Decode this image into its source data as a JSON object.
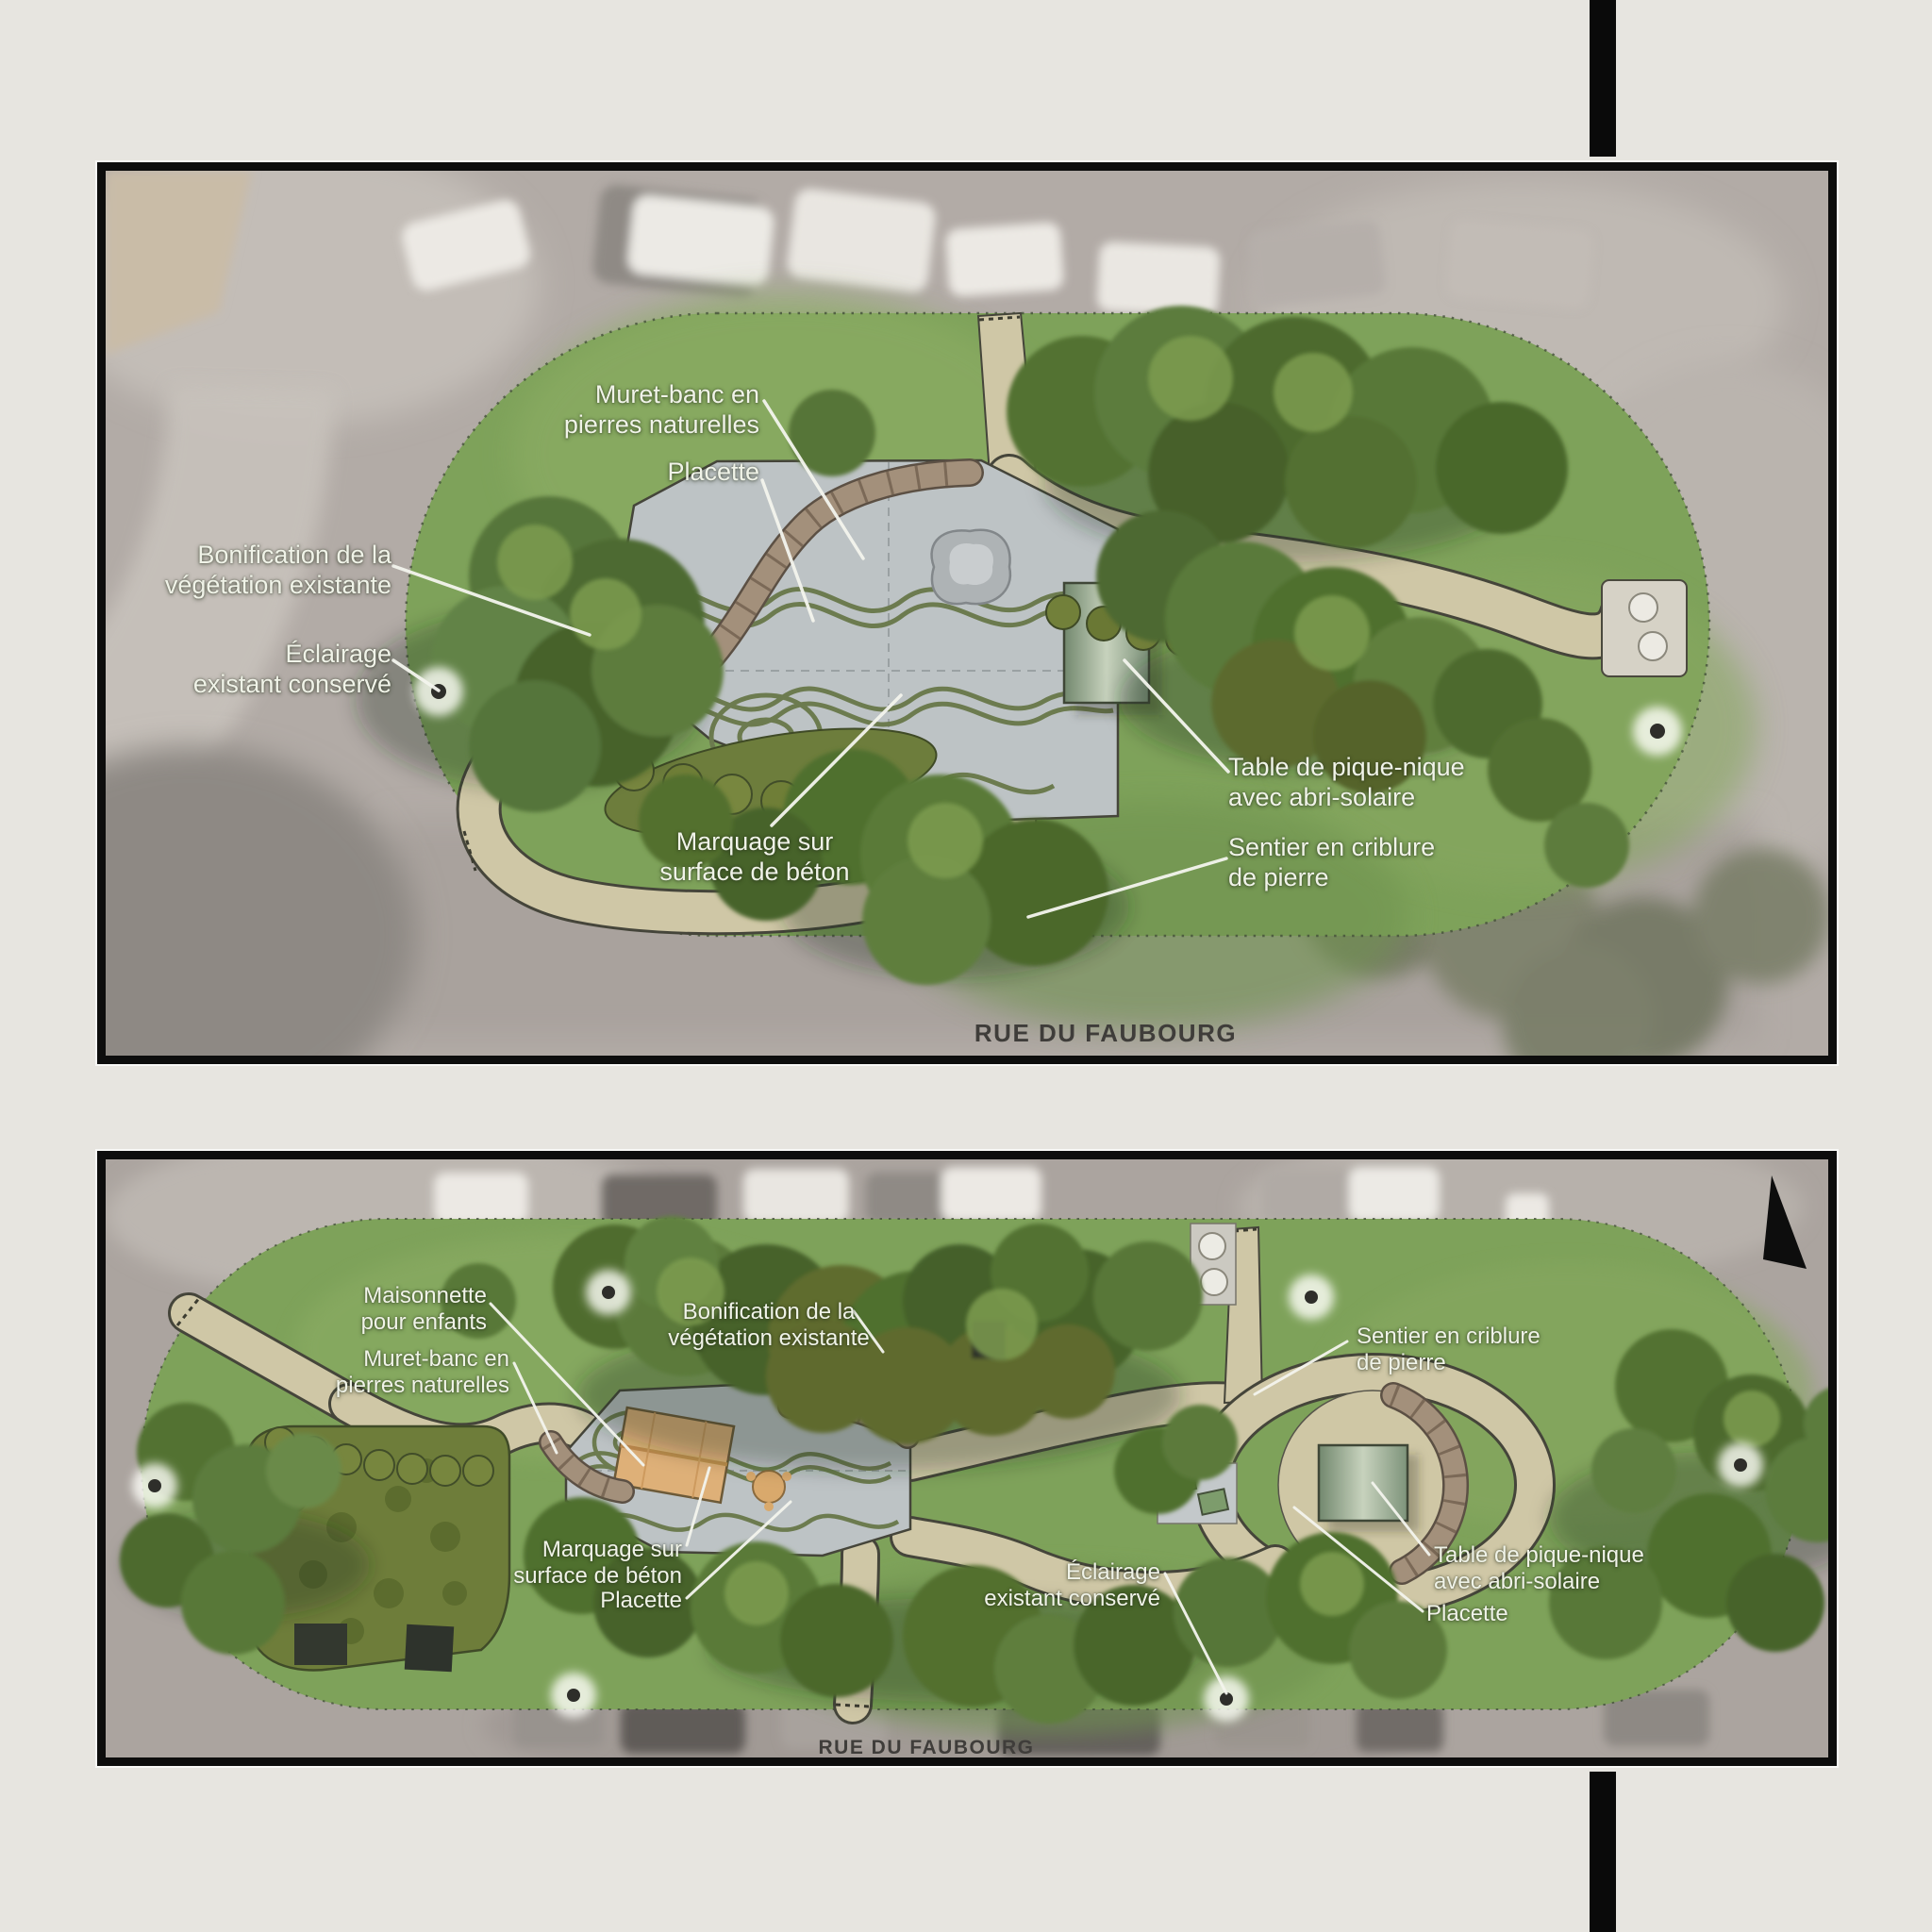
{
  "page": {
    "background": "#e7e5e0",
    "divider_color": "#0a0a0a",
    "frame_border_color": "#0d0d0d"
  },
  "colors": {
    "annotation_text": "#f0f3e8",
    "street_text": "#3f3d3a",
    "grass": "#7ea25a",
    "path": "#cfc7a6",
    "plaza_concrete": "#bdc3c5",
    "plaza_marking": "#6c7b4f",
    "stone_wall": "#9d8973",
    "shelter": "#8aa184",
    "maisonnette": "#deb078",
    "bench": "#c26f3e",
    "asphalt": "#b0a9a4"
  },
  "icons": {
    "north_arrow": "north-arrow-icon",
    "streetlight": "streetlight-icon"
  },
  "panel_top": {
    "street_label": "RUE DU FAUBOURG",
    "annotations": [
      {
        "id": "bonification",
        "lines": [
          "Bonification de la",
          "végétation existante"
        ]
      },
      {
        "id": "eclairage",
        "lines": [
          "Éclairage",
          "existant conservé"
        ]
      },
      {
        "id": "muret",
        "lines": [
          "Muret-banc en",
          "pierres naturelles"
        ]
      },
      {
        "id": "placette",
        "lines": [
          "Placette"
        ]
      },
      {
        "id": "marquage",
        "lines": [
          "Marquage sur",
          "surface de béton"
        ]
      },
      {
        "id": "table",
        "lines": [
          "Table de pique-nique",
          "avec abri-solaire"
        ]
      },
      {
        "id": "sentier",
        "lines": [
          "Sentier en criblure",
          "de pierre"
        ]
      }
    ]
  },
  "panel_bottom": {
    "street_label": "RUE DU FAUBOURG",
    "annotations": [
      {
        "id": "maisonnette",
        "lines": [
          "Maisonnette",
          "pour enfants"
        ]
      },
      {
        "id": "muret",
        "lines": [
          "Muret-banc en",
          "pierres naturelles"
        ]
      },
      {
        "id": "bonification",
        "lines": [
          "Bonification de la",
          "végétation existante"
        ]
      },
      {
        "id": "sentier",
        "lines": [
          "Sentier en criblure",
          "de pierre"
        ]
      },
      {
        "id": "marquage",
        "lines": [
          "Marquage sur",
          "surface de béton"
        ]
      },
      {
        "id": "placette_west",
        "lines": [
          "Placette"
        ]
      },
      {
        "id": "eclairage",
        "lines": [
          "Éclairage",
          "existant conservé"
        ]
      },
      {
        "id": "table",
        "lines": [
          "Table de pique-nique",
          "avec abri-solaire"
        ]
      },
      {
        "id": "placette_east",
        "lines": [
          "Placette"
        ]
      }
    ]
  }
}
